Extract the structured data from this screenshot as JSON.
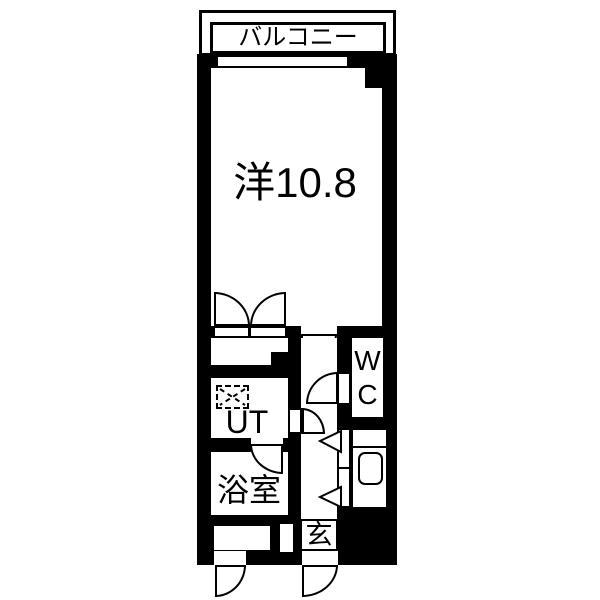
{
  "plan": {
    "balcony_label": "バルコニー",
    "main_room_label": "洋10.8",
    "ut_label": "UT",
    "bath_label": "浴室",
    "wc_line1": "W",
    "wc_line2": "C",
    "entrance_label": "玄",
    "colors": {
      "wall": "#000000",
      "floor": "#ffffff"
    }
  }
}
